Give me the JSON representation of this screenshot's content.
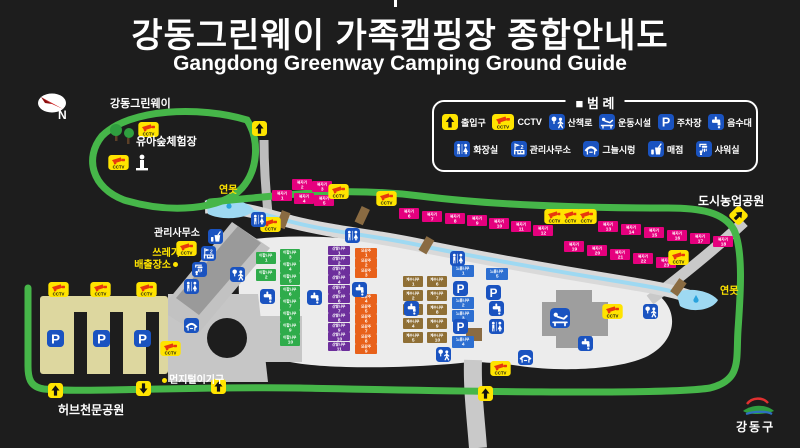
{
  "title": {
    "ko": "강동그린웨이 가족캠핑장 종합안내도",
    "en": "Gangdong Greenway Camping Ground Guide"
  },
  "compass": {
    "label": "N"
  },
  "legend": {
    "title": "■ 범 례",
    "items": [
      {
        "icon": "entrance",
        "label": "출입구"
      },
      {
        "icon": "cctv",
        "label": "CCTV"
      },
      {
        "icon": "walk",
        "label": "산책로"
      },
      {
        "icon": "exercise",
        "label": "운동시설"
      },
      {
        "icon": "parking",
        "label": "주차장"
      },
      {
        "icon": "water",
        "label": "음수대"
      },
      {
        "icon": "toilet",
        "label": "화장실"
      },
      {
        "icon": "office",
        "label": "관리사무소"
      },
      {
        "icon": "shade",
        "label": "그늘시렁"
      },
      {
        "icon": "store",
        "label": "매점"
      },
      {
        "icon": "shower",
        "label": "샤워실"
      }
    ]
  },
  "map_labels": [
    {
      "id": "greenway",
      "text": "강동그린웨이"
    },
    {
      "id": "forest",
      "text": "유아숲체험장"
    },
    {
      "id": "pond-left",
      "text": "연못"
    },
    {
      "id": "pond-right",
      "text": "연못"
    },
    {
      "id": "office",
      "text": "관리사무소"
    },
    {
      "id": "trash",
      "text": "쓰레기\n배출장소"
    },
    {
      "id": "dust",
      "text": "먼지털이기구"
    },
    {
      "id": "herb",
      "text": "허브천문공원"
    },
    {
      "id": "city-farm",
      "text": "도시농업공원"
    }
  ],
  "camp_series": [
    {
      "id": "pink",
      "name": "복자기",
      "color": "#e5007e",
      "count": 23
    },
    {
      "id": "green",
      "name": "이팝나무",
      "color": "#2fac4b",
      "count": 10
    },
    {
      "id": "purple",
      "name": "산딸나무",
      "color": "#6d2f9c",
      "count": 11
    },
    {
      "id": "orange",
      "name": "모감주",
      "color": "#e8611a",
      "count": 9
    },
    {
      "id": "khaki",
      "name": "계수나무",
      "color": "#8f6f35",
      "count": 10
    },
    {
      "id": "blue",
      "name": "느릅나무",
      "color": "#2d6fd1",
      "count": 5
    }
  ],
  "footer_logo": {
    "text": "강동구"
  },
  "colors": {
    "trail": "#46b649",
    "stream": "#9ed9f2",
    "icon_blue": "#1a53c0",
    "icon_yellow": "#ffe400",
    "parking_lot": "#ddd79f",
    "road": "#c6c6c6"
  }
}
